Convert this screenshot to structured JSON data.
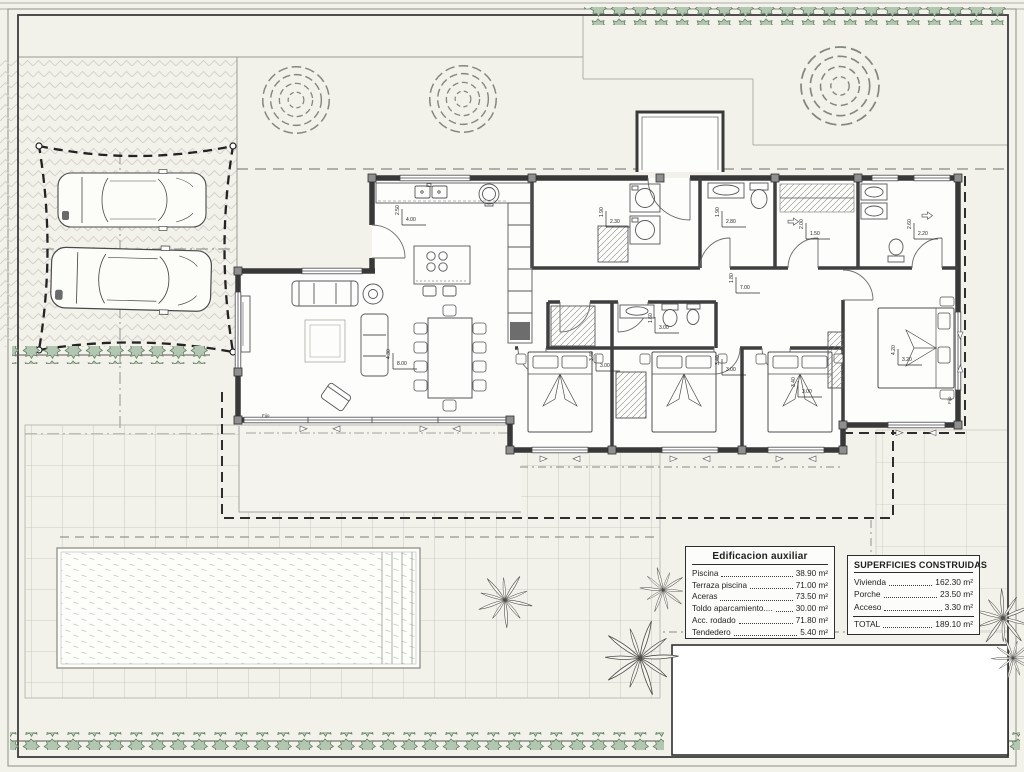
{
  "document": {
    "kind": "architectural site and floor plan",
    "colors": {
      "paper": "#f2f1ea",
      "wall": "#383838",
      "hedge_fill": "#b3c6b2",
      "hedge_stroke": "#638064",
      "paving_line": "#bfbeb7",
      "water_line": "#bac4c6",
      "boundary": "#3c3c3c"
    }
  },
  "plan": {
    "fijo_labels": [
      "Fijo",
      "Fijo"
    ],
    "dims": [
      "4.00",
      "2.50",
      "8.00",
      "4.30",
      "2.30",
      "1.90",
      "2.80",
      "1.90",
      "7.00",
      "1.80",
      "1.50",
      "2.00",
      "2.20",
      "2.60",
      "3.00",
      "3.40",
      "3.00",
      "3.40",
      "3.00",
      "3.40",
      "3.20",
      "4.20",
      "3.00",
      "1.60"
    ]
  },
  "legend_tables": {
    "auxiliary": {
      "title": "Edificacion auxiliar",
      "rows": [
        {
          "label": "Piscina",
          "value": "38.90 m²"
        },
        {
          "label": "Terraza piscina",
          "value": "71.00 m²"
        },
        {
          "label": "Aceras",
          "value": "73.50 m²"
        },
        {
          "label": "Toldo aparcamiento....",
          "value": "30.00 m²"
        },
        {
          "label": "Acc. rodado",
          "value": "71.80 m²"
        },
        {
          "label": "Tendedero",
          "value": "5.40 m²"
        }
      ]
    },
    "built": {
      "title": "SUPERFICIES CONSTRUIDAS",
      "rows": [
        {
          "label": "Vivienda",
          "value": "162.30 m²"
        },
        {
          "label": "Porche",
          "value": "23.50 m²"
        },
        {
          "label": "Acceso",
          "value": "3.30 m²"
        }
      ],
      "total": {
        "label": "TOTAL",
        "value": "189.10 m²"
      }
    }
  }
}
